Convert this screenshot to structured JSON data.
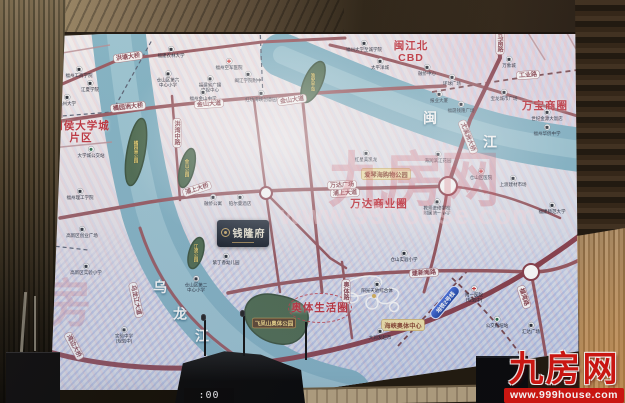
{
  "screen": {
    "project": {
      "name": "钱隆府"
    },
    "zones": [
      {
        "label": "闽江北\nCBD",
        "x": 411,
        "y": 52
      },
      {
        "label": "万宝商圈",
        "x": 545,
        "y": 106
      },
      {
        "label": "闽侯大学城\n片区",
        "x": 81,
        "y": 132
      },
      {
        "label": "万达商业圈",
        "x": 379,
        "y": 204
      },
      {
        "label": "奥体生活圈",
        "x": 320,
        "y": 308
      }
    ],
    "rivers": [
      {
        "name": "闽江",
        "chars": [
          {
            "t": "闽",
            "x": 430,
            "y": 118
          },
          {
            "t": "江",
            "x": 490,
            "y": 142
          }
        ]
      },
      {
        "name": "乌龙江",
        "chars": [
          {
            "t": "乌",
            "x": 160,
            "y": 287
          },
          {
            "t": "龙",
            "x": 180,
            "y": 314
          },
          {
            "t": "江",
            "x": 202,
            "y": 336
          }
        ]
      }
    ],
    "roads": [
      {
        "label": "洪塘大桥",
        "x": 128,
        "y": 57,
        "r": -8
      },
      {
        "label": "橘园洲大桥",
        "x": 128,
        "y": 107,
        "r": -6
      },
      {
        "label": "金山大道",
        "x": 209,
        "y": 104,
        "r": -4
      },
      {
        "label": "金山大道",
        "x": 292,
        "y": 100,
        "r": -8
      },
      {
        "label": "洪湾中路",
        "x": 177,
        "y": 133,
        "v": true
      },
      {
        "label": "浦上大桥",
        "x": 197,
        "y": 189,
        "r": -18
      },
      {
        "label": "浦上大道",
        "x": 345,
        "y": 193,
        "r": -3
      },
      {
        "label": "万达广场",
        "x": 342,
        "y": 185,
        "r": -3
      },
      {
        "label": "工业路",
        "x": 528,
        "y": 75,
        "r": -4
      },
      {
        "label": "白马南路",
        "x": 500,
        "y": 40,
        "v": true
      },
      {
        "label": "尤溪洲大桥",
        "x": 468,
        "y": 137,
        "r": 68
      },
      {
        "label": "乌龙江大道",
        "x": 136,
        "y": 300,
        "r": 78
      },
      {
        "label": "湾边大桥",
        "x": 74,
        "y": 346,
        "r": 62
      },
      {
        "label": "建新南路",
        "x": 424,
        "y": 273,
        "r": -4
      },
      {
        "label": "福湾路",
        "x": 524,
        "y": 297,
        "r": 72
      },
      {
        "label": "奥体路",
        "x": 346,
        "y": 291,
        "v": true
      }
    ],
    "pois": [
      {
        "label": "福州工商学院",
        "x": 79,
        "y": 72,
        "type": "school"
      },
      {
        "label": "江夏学院",
        "x": 90,
        "y": 86,
        "type": "school"
      },
      {
        "label": "福州大学",
        "x": 67,
        "y": 100,
        "type": "school"
      },
      {
        "label": "大学城公交站",
        "x": 91,
        "y": 152,
        "type": "bus"
      },
      {
        "label": "福州理工学院",
        "x": 80,
        "y": 194,
        "type": "school"
      },
      {
        "label": "高新区创业广场",
        "x": 82,
        "y": 232,
        "type": "building"
      },
      {
        "label": "高新区实验小学",
        "x": 86,
        "y": 269,
        "type": "school"
      },
      {
        "label": "实验中学\n(规划中)",
        "x": 124,
        "y": 335,
        "type": "school"
      },
      {
        "label": "福建农林大学",
        "x": 171,
        "y": 52,
        "type": "school"
      },
      {
        "label": "仓山区第六\n中心小学",
        "x": 168,
        "y": 79,
        "type": "school"
      },
      {
        "label": "福州空军医院",
        "x": 229,
        "y": 64,
        "type": "hospital"
      },
      {
        "label": "闽江学院附中",
        "x": 248,
        "y": 77,
        "type": "school"
      },
      {
        "label": "福建省广播\n电视中心",
        "x": 210,
        "y": 84,
        "type": "building"
      },
      {
        "label": "福州金山中学",
        "x": 203,
        "y": 95,
        "type": "school"
      },
      {
        "label": "红坊海峡创意园",
        "x": 261,
        "y": 96,
        "type": "building"
      },
      {
        "label": "福州大学至诚学院",
        "x": 364,
        "y": 46,
        "type": "school"
      },
      {
        "label": "太平洋城",
        "x": 380,
        "y": 64,
        "type": "building"
      },
      {
        "label": "融侨中心",
        "x": 427,
        "y": 70,
        "type": "building"
      },
      {
        "label": "环球广场",
        "x": 452,
        "y": 80,
        "type": "building"
      },
      {
        "label": "报业大厦",
        "x": 439,
        "y": 97,
        "type": "building"
      },
      {
        "label": "福晟钱隆广场",
        "x": 461,
        "y": 107,
        "type": "building"
      },
      {
        "label": "万象城",
        "x": 509,
        "y": 62,
        "type": "mall"
      },
      {
        "label": "宝龙城市广场",
        "x": 504,
        "y": 95,
        "type": "mall"
      },
      {
        "label": "世纪金源大饭店",
        "x": 547,
        "y": 115,
        "type": "building"
      },
      {
        "label": "福州华侨中学",
        "x": 547,
        "y": 130,
        "type": "school"
      },
      {
        "label": "红星美凯龙",
        "x": 366,
        "y": 156,
        "type": "mall"
      },
      {
        "label": "教师进修学校\n附属第一小学",
        "x": 437,
        "y": 207,
        "type": "school"
      },
      {
        "label": "仓山实验小学",
        "x": 404,
        "y": 256,
        "type": "school"
      },
      {
        "label": "海润滨江花园",
        "x": 438,
        "y": 157,
        "type": "building"
      },
      {
        "label": "上渡建材市场",
        "x": 513,
        "y": 181,
        "type": "building"
      },
      {
        "label": "仓山区医院",
        "x": 481,
        "y": 174,
        "type": "hospital"
      },
      {
        "label": "融侨公寓",
        "x": 213,
        "y": 200,
        "type": "building"
      },
      {
        "label": "铂尔曼酒店",
        "x": 240,
        "y": 200,
        "type": "building"
      },
      {
        "label": "紫丁香幼儿园",
        "x": 226,
        "y": 259,
        "type": "school"
      },
      {
        "label": "仓山区第二\n中心小学",
        "x": 196,
        "y": 284,
        "type": "school"
      },
      {
        "label": "附一医院\n(规划中)",
        "x": 474,
        "y": 294,
        "type": "hospital"
      },
      {
        "label": "福建师范大学",
        "x": 552,
        "y": 208,
        "type": "school"
      },
      {
        "label": "公交枢纽站",
        "x": 497,
        "y": 322,
        "type": "bus"
      },
      {
        "label": "汇达广场",
        "x": 531,
        "y": 328,
        "type": "building"
      },
      {
        "label": "大润发超市",
        "x": 380,
        "y": 334,
        "type": "mall"
      },
      {
        "label": "阳光天地综合体",
        "x": 377,
        "y": 287,
        "type": "building"
      },
      {
        "label": "大名城",
        "x": 598,
        "y": 58,
        "type": "building"
      }
    ],
    "parks": [
      {
        "name": "橘园洲公园",
        "x": 136,
        "y": 152
      },
      {
        "name": "金山公园",
        "x": 187,
        "y": 168
      },
      {
        "name": "江滨公园",
        "x": 196,
        "y": 253
      },
      {
        "name": "淮安半岛",
        "x": 313,
        "y": 82
      }
    ],
    "yellow_labels": [
      {
        "label": "爱琴海购物公园"
      },
      {
        "label": "海峡奥体中心"
      },
      {
        "label": "飞凤山奥体公园"
      }
    ],
    "metro": {
      "label": "地铁2号线"
    },
    "watermark": {
      "brand": "九房网",
      "url": "www.99house.com",
      "partial": "房"
    }
  },
  "logo": {
    "brand": "九房网",
    "url": "www.999house.com"
  },
  "equipment": {
    "display_text": ":00"
  }
}
